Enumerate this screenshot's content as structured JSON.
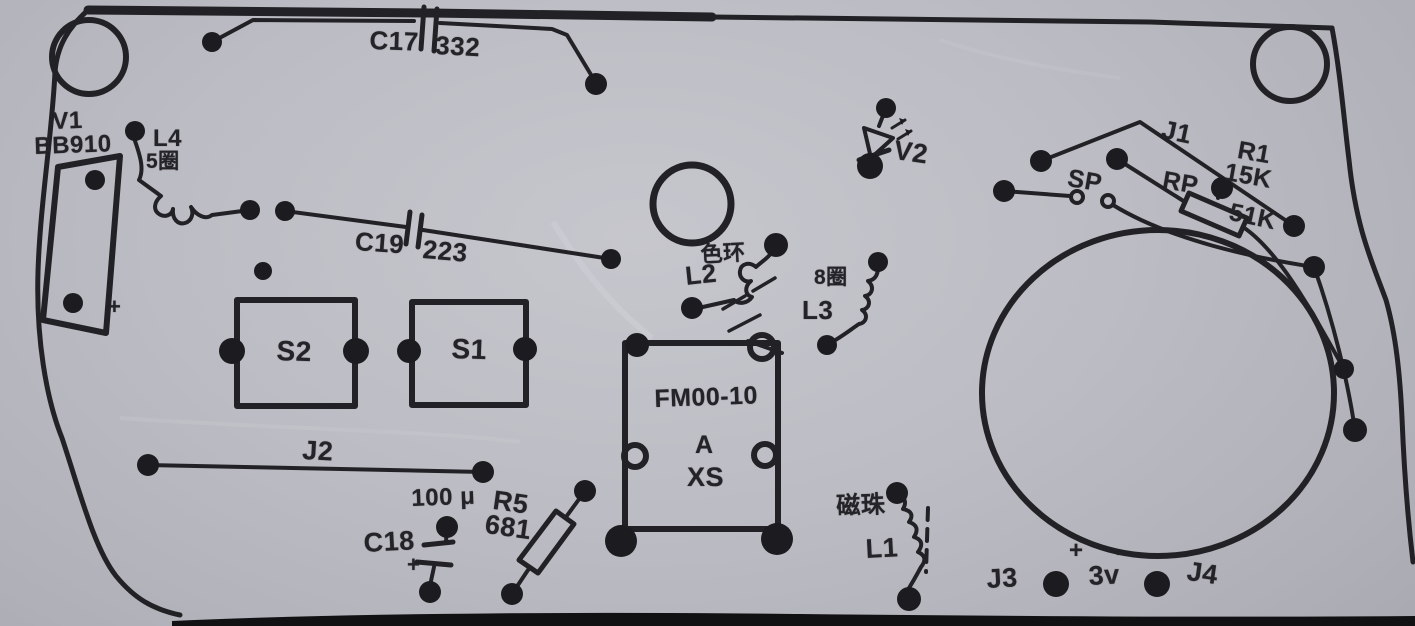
{
  "title": "FM radio PCB component layout diagram (scanned print)",
  "colors": {
    "paper": "#bcbcc4",
    "ink": "#222226",
    "pad": "#1c1c20",
    "photo_edge": "#111114"
  },
  "components": {
    "c17": {
      "ref": "C17",
      "value": "332"
    },
    "v1": {
      "ref": "V1",
      "part": "BB910",
      "polarity": "+"
    },
    "l4": {
      "ref": "L4",
      "turns": "5圈"
    },
    "c19": {
      "ref": "C19",
      "value": "223"
    },
    "s2": {
      "ref": "S2"
    },
    "s1": {
      "ref": "S1"
    },
    "l2": {
      "ref": "L2",
      "note": "色环"
    },
    "l3": {
      "ref": "L3",
      "turns": "8圈"
    },
    "v2": {
      "ref": "V2"
    },
    "j1": {
      "ref": "J1"
    },
    "r1": {
      "ref": "R1",
      "value": "15K"
    },
    "rp": {
      "ref": "RP",
      "value": "51K"
    },
    "sp": {
      "ref": "SP"
    },
    "module": {
      "name": "FM00-10",
      "line2": "A",
      "line3": "XS"
    },
    "j2": {
      "ref": "J2"
    },
    "c18": {
      "ref": "C18",
      "value": "100 μ",
      "polarity": "+"
    },
    "r5": {
      "ref": "R5",
      "value": "681"
    },
    "l1": {
      "ref": "L1",
      "note": "磁珠"
    }
  },
  "power": {
    "j3": "J3",
    "j4": "J4",
    "voltage": "3v",
    "plus": "+",
    "minus": "-"
  }
}
